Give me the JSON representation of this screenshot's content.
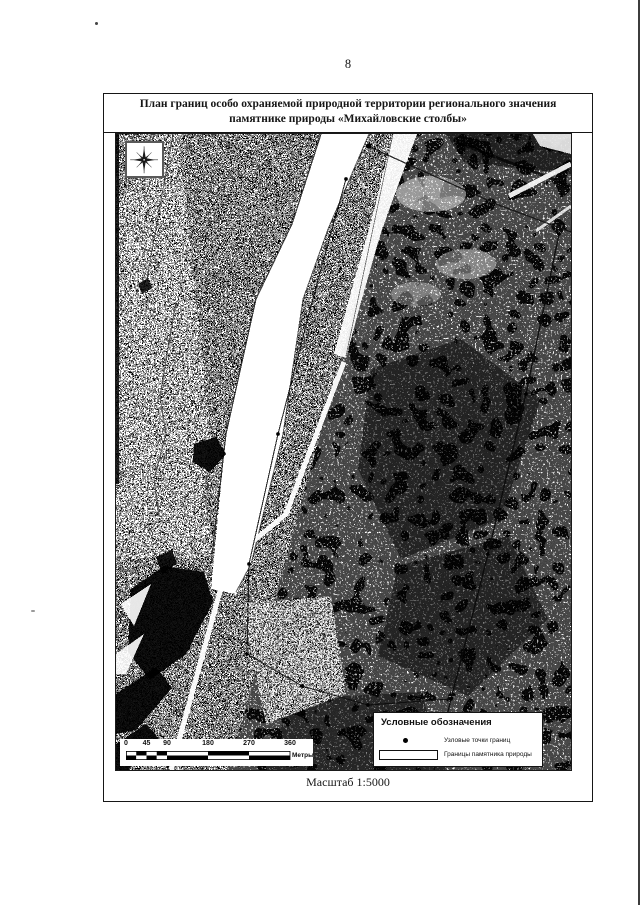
{
  "page": {
    "number": "8"
  },
  "document": {
    "title": "План границ особо охраняемой природной территории регионального значения памятнике природы «Михайловские столбы»",
    "scale_caption": "Масштаб 1:5000"
  },
  "map": {
    "kind": "black-and-white aerial photograph",
    "visible_features": "river running diagonally with light floodplain at left, dark forest massif at right, thin boundary lines with node points"
  },
  "scalebar": {
    "ticks": [
      "0",
      "45",
      "90",
      "180",
      "270",
      "360"
    ],
    "unit_label": "Метры"
  },
  "legend": {
    "title": "Условные обозначения",
    "items": [
      {
        "symbol": "node-point",
        "label": "Узловые точки границ"
      },
      {
        "symbol": "boundary-rectangle",
        "label": "Границы памятника природы"
      }
    ]
  },
  "colors": {
    "ink": "#161616",
    "paper": "#ffffff"
  }
}
